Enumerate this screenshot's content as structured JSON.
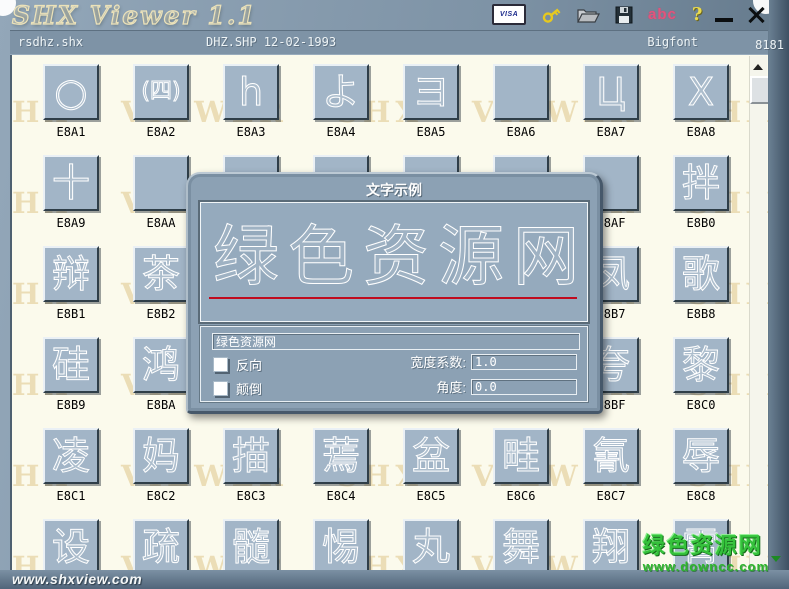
{
  "window": {
    "title": "SHX Viewer 1.1"
  },
  "titlebar": {
    "visa_label": "VISA",
    "abc_label": "abc",
    "help_label": "?"
  },
  "statusbar": {
    "file_name": "rsdhz.shx",
    "file_info": "DHZ.SHP 12-02-1993",
    "font_type": "Bigfont",
    "count": "8181"
  },
  "watermark": {
    "text": "SHX VIEWER"
  },
  "grid": {
    "cells": [
      {
        "code": "E8A1",
        "glyph": "○"
      },
      {
        "code": "E8A2",
        "glyph": "(四)"
      },
      {
        "code": "E8A3",
        "glyph": "h"
      },
      {
        "code": "E8A4",
        "glyph": "よ"
      },
      {
        "code": "E8A5",
        "glyph": "ヨ"
      },
      {
        "code": "E8A6",
        "glyph": ""
      },
      {
        "code": "E8A7",
        "glyph": "Ц"
      },
      {
        "code": "E8A8",
        "glyph": "Х"
      },
      {
        "code": "E8A9",
        "glyph": "十"
      },
      {
        "code": "E8AA",
        "glyph": ""
      },
      {
        "code": "",
        "glyph": ""
      },
      {
        "code": "",
        "glyph": ""
      },
      {
        "code": "",
        "glyph": ""
      },
      {
        "code": "",
        "glyph": ""
      },
      {
        "code": "E8AF",
        "glyph": ""
      },
      {
        "code": "E8B0",
        "glyph": "拌"
      },
      {
        "code": "E8B1",
        "glyph": "辩"
      },
      {
        "code": "E8B2",
        "glyph": "茶"
      },
      {
        "code": "",
        "glyph": ""
      },
      {
        "code": "",
        "glyph": ""
      },
      {
        "code": "",
        "glyph": ""
      },
      {
        "code": "",
        "glyph": ""
      },
      {
        "code": "E8B7",
        "glyph": "凤"
      },
      {
        "code": "E8B8",
        "glyph": "歌"
      },
      {
        "code": "E8B9",
        "glyph": "硅"
      },
      {
        "code": "E8BA",
        "glyph": "鸿"
      },
      {
        "code": "",
        "glyph": ""
      },
      {
        "code": "",
        "glyph": ""
      },
      {
        "code": "",
        "glyph": ""
      },
      {
        "code": "",
        "glyph": ""
      },
      {
        "code": "E8BF",
        "glyph": "夸"
      },
      {
        "code": "E8C0",
        "glyph": "黎"
      },
      {
        "code": "E8C1",
        "glyph": "凌"
      },
      {
        "code": "E8C2",
        "glyph": "妈"
      },
      {
        "code": "E8C3",
        "glyph": "描"
      },
      {
        "code": "E8C4",
        "glyph": "蔫"
      },
      {
        "code": "E8C5",
        "glyph": "盆"
      },
      {
        "code": "E8C6",
        "glyph": "畦"
      },
      {
        "code": "E8C7",
        "glyph": "氰"
      },
      {
        "code": "E8C8",
        "glyph": "辱"
      },
      {
        "code": "",
        "glyph": "设"
      },
      {
        "code": "",
        "glyph": "疏"
      },
      {
        "code": "",
        "glyph": "髓"
      },
      {
        "code": "",
        "glyph": "惕"
      },
      {
        "code": "",
        "glyph": "丸"
      },
      {
        "code": "",
        "glyph": "舞"
      },
      {
        "code": "",
        "glyph": "翔"
      },
      {
        "code": "",
        "glyph": "霄"
      }
    ]
  },
  "dialog": {
    "title": "文字示例",
    "preview_text": "绿色资源网",
    "input_value": "绿色资源网",
    "reverse_label": "反向",
    "flip_label": "颠倒",
    "width_label": "宽度系数:",
    "width_value": "1.0",
    "angle_label": "角度:",
    "angle_value": "0.0"
  },
  "footer": {
    "site": "www.shxview.com"
  },
  "overlay": {
    "line1": "绿色资源网",
    "line2": "www.downcc.com"
  },
  "colors": {
    "button_face": "#a2b5c7",
    "client_bg": "#fbfaec",
    "dialog_face": "#8ca1b4",
    "underline_red": "#c00b1e",
    "watermark_green": "#2db52d",
    "title_cream": "#ece2b9"
  }
}
